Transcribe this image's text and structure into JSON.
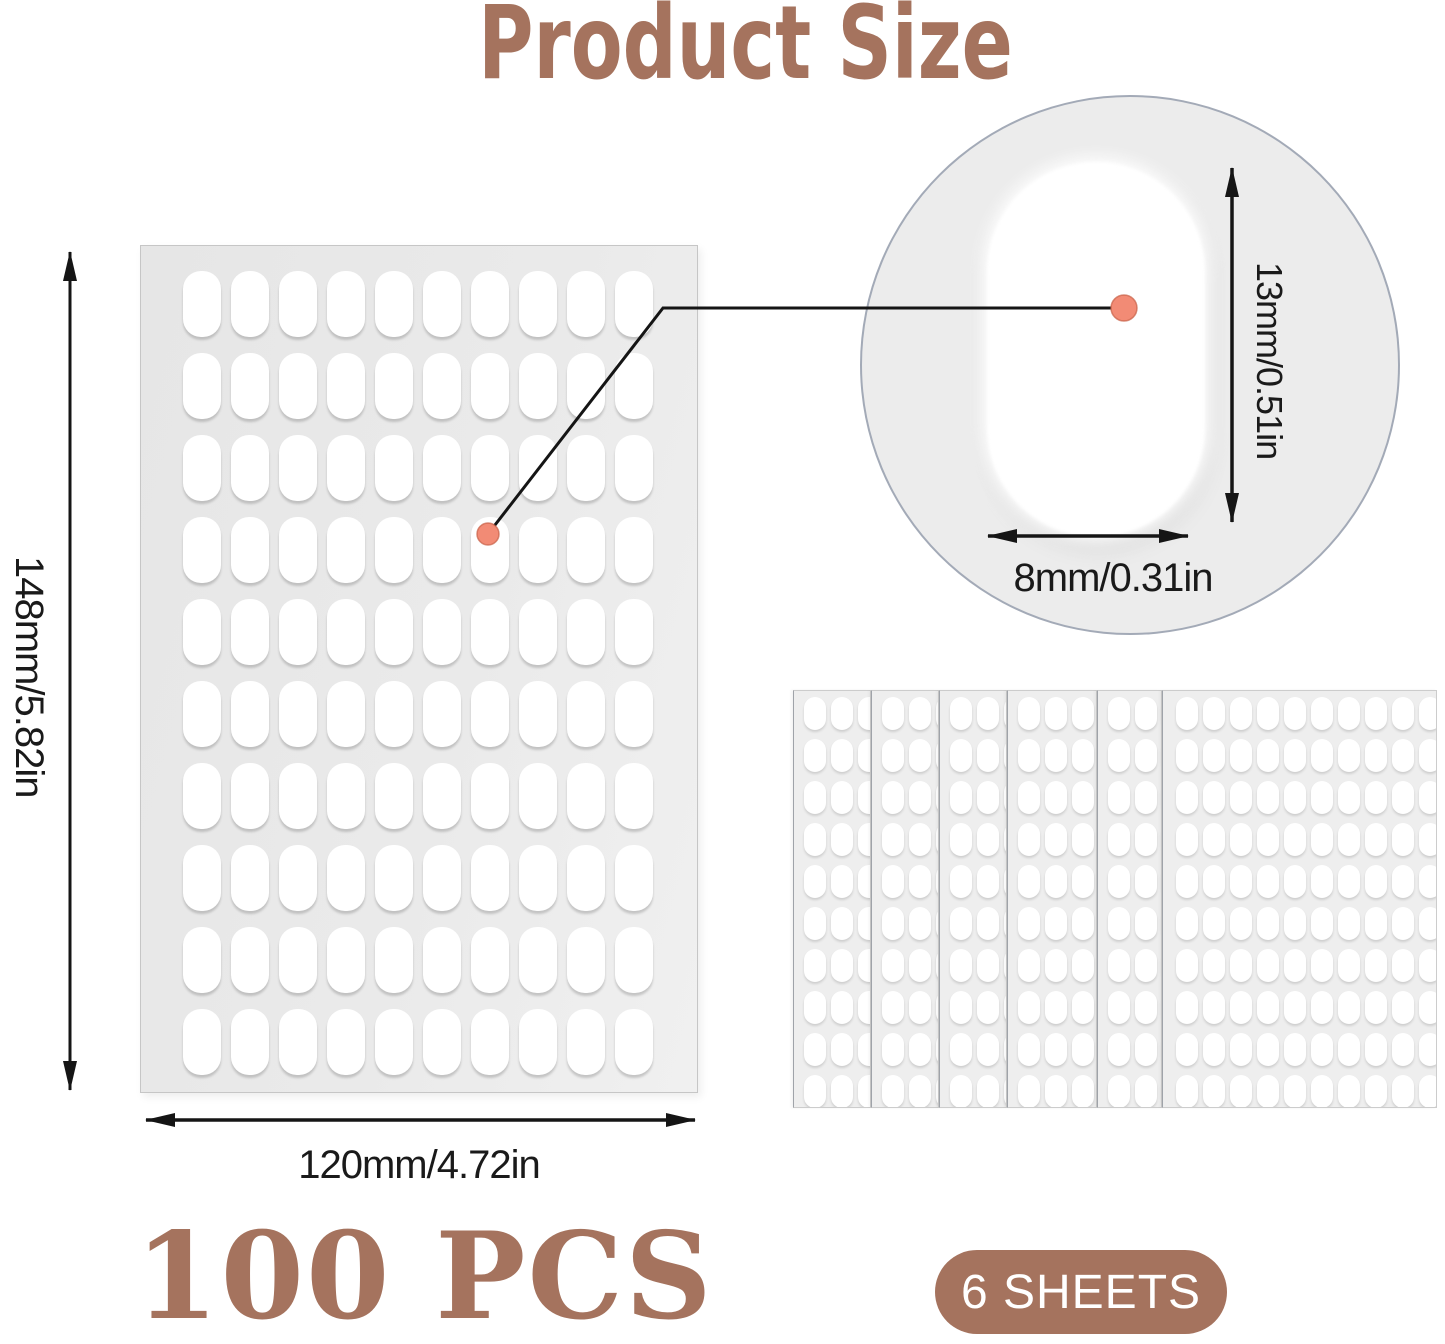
{
  "title": "Product Size",
  "sheet": {
    "rows": 10,
    "cols": 10,
    "pieces_per_sheet": 100,
    "height_label": "148mm/5.82in",
    "width_label": "120mm/4.72in"
  },
  "magnifier": {
    "height_label": "13mm/0.51in",
    "width_label": "8mm/0.31in"
  },
  "stack": {
    "sheet_count": 6,
    "rows": 10,
    "full_sheet_cols": 10,
    "strip_cols": 3
  },
  "labels": {
    "pieces": "100 PCS",
    "sheets_badge": "6 SHEETS"
  },
  "colors": {
    "brand": "#A5735E",
    "ink": "#1a1a1a",
    "sheet_bg": "#e9e9e9",
    "pill": "#ffffff",
    "circle_bg": "#ececec",
    "circle_border": "#8a92a2",
    "callout_dot": "#F28B75",
    "arrow": "#151515"
  }
}
